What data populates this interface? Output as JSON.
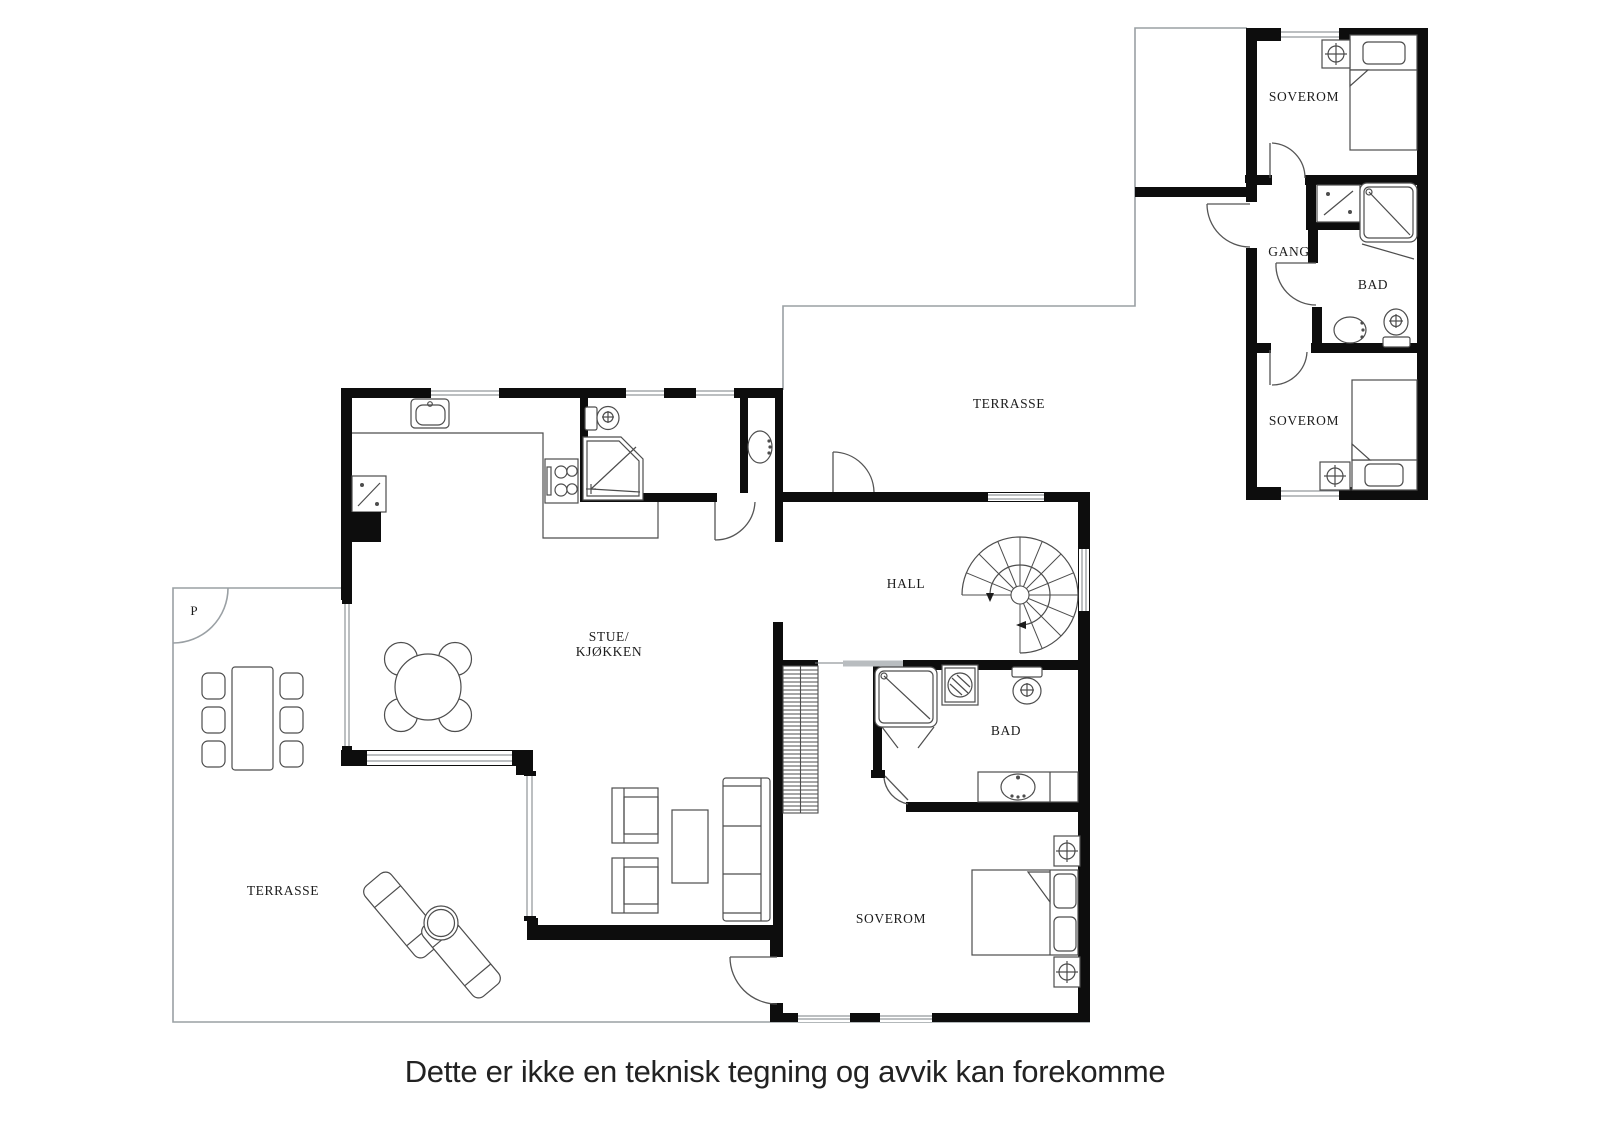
{
  "colors": {
    "wall": "#0d0d0d",
    "furniture_line": "#4d4d4d",
    "terrace_line": "#9aa0a4",
    "text": "#1c1c1c"
  },
  "labels": {
    "soverom_wing_top": "SOVEROM",
    "gang": "GANG",
    "bad_wing": "BAD",
    "soverom_wing_bottom": "SOVEROM",
    "terrasse_top": "TERRASSE",
    "hall": "HALL",
    "stue_line1": "STUE/",
    "stue_line2": "KJØKKEN",
    "bad_main": "BAD",
    "soverom_main": "SOVEROM",
    "terrasse_main": "TERRASSE",
    "parking": "P"
  },
  "disclaimer": "Dette er ikke en teknisk tegning og avvik kan forekomme"
}
